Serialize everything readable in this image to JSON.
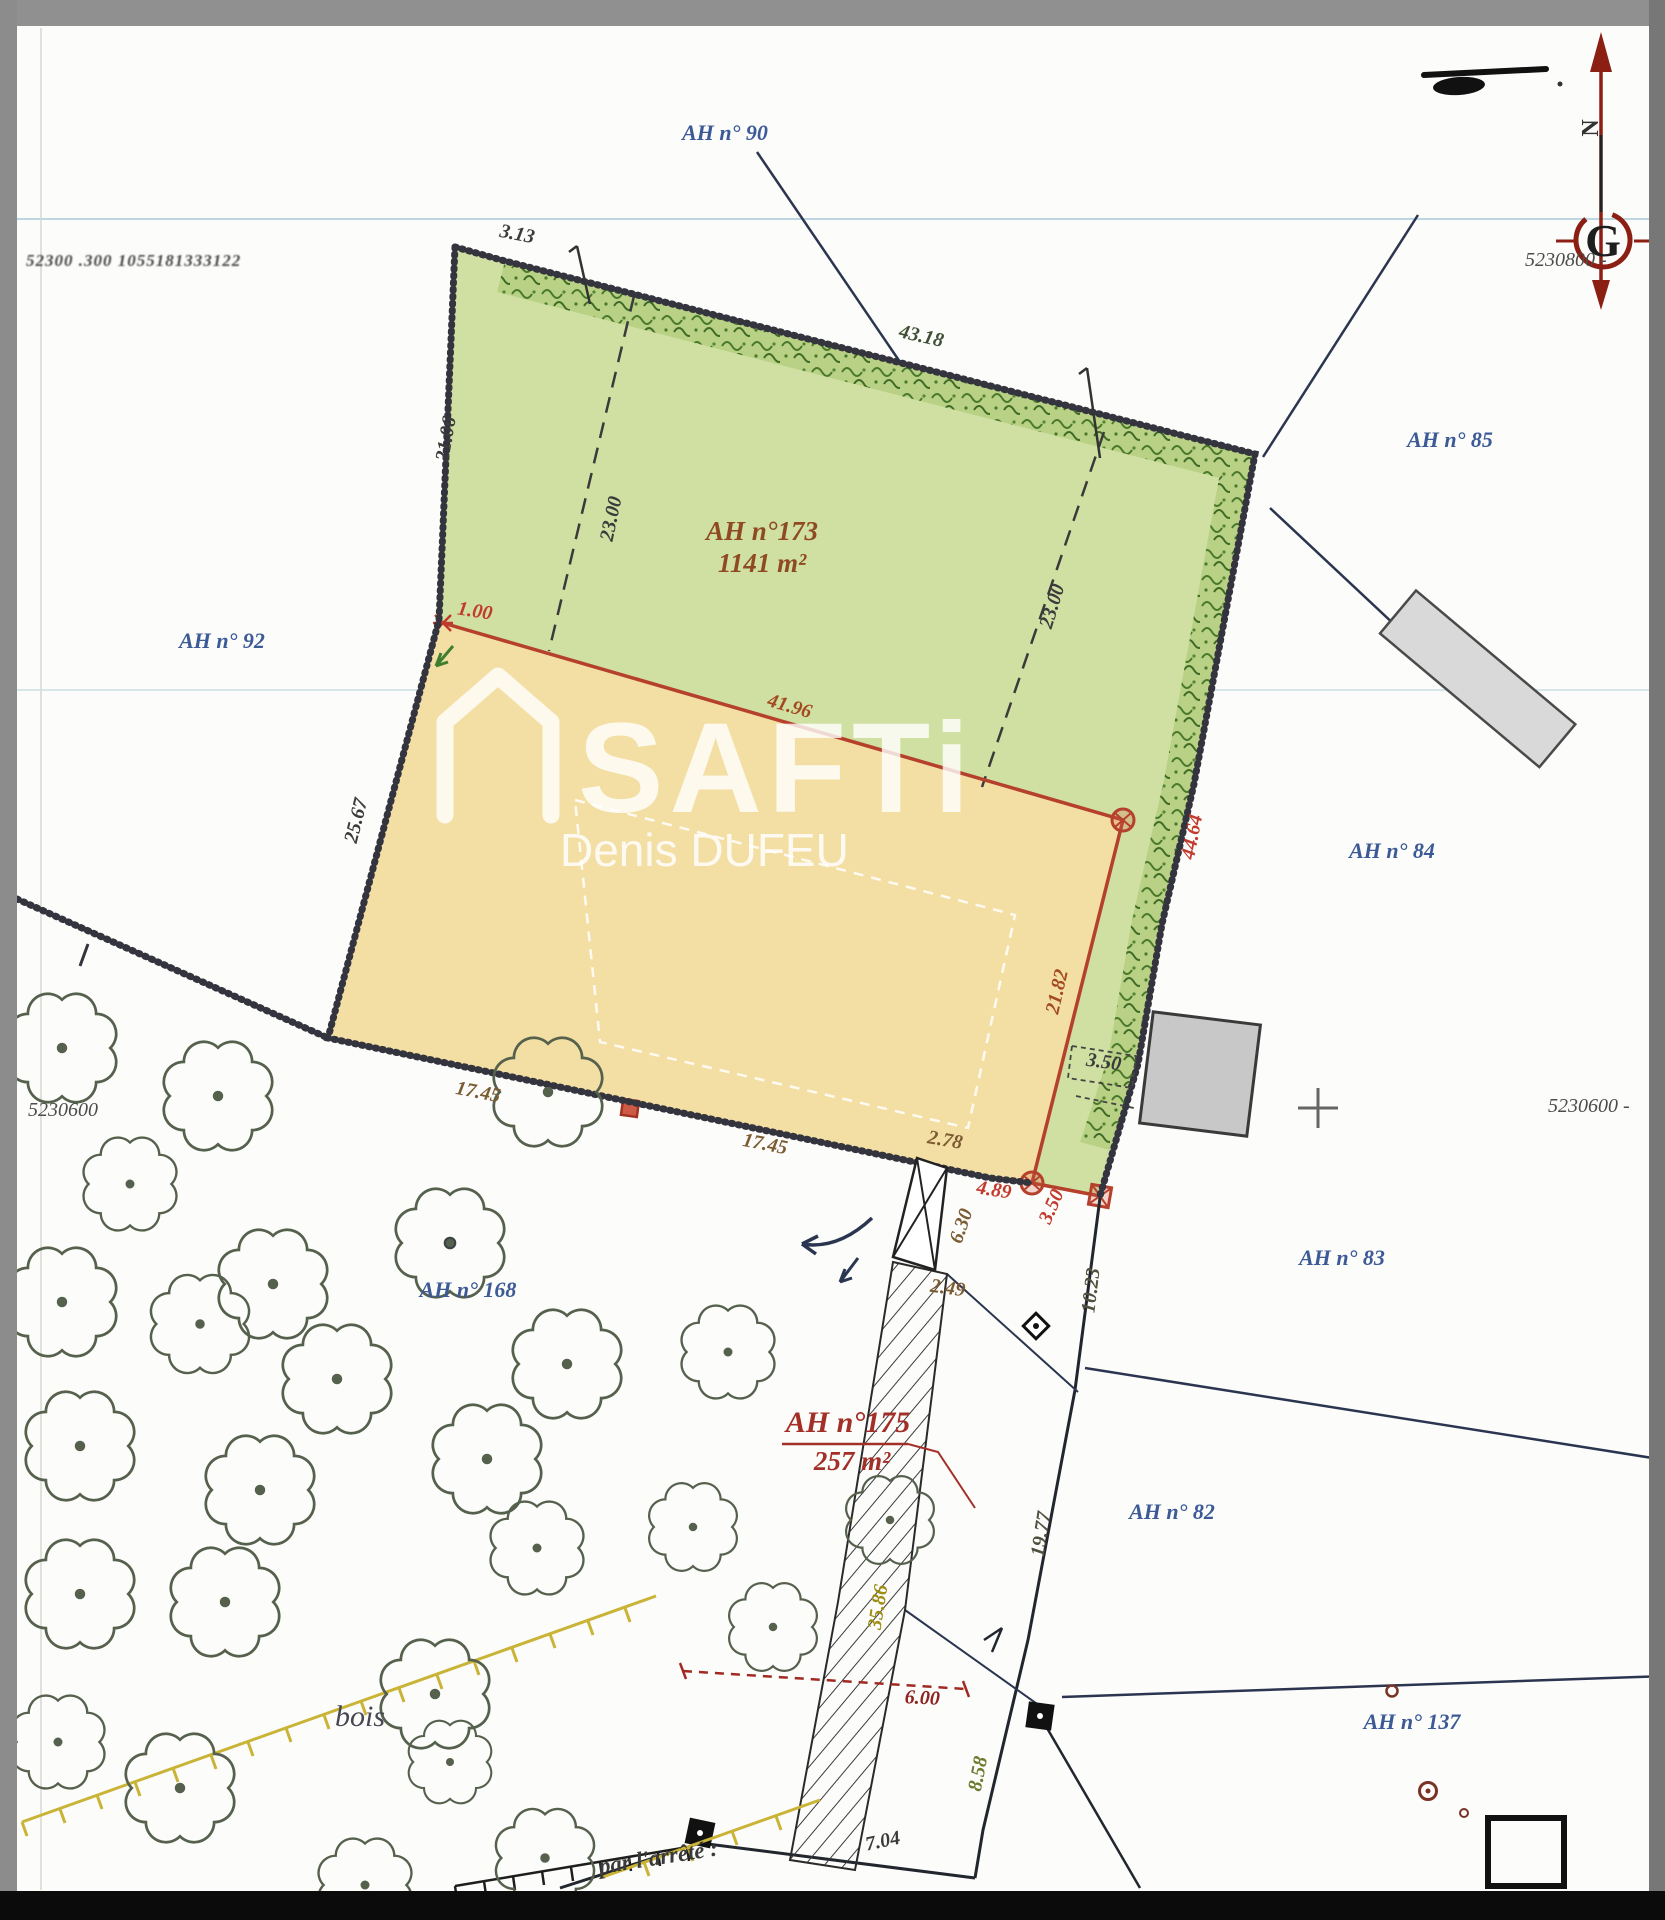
{
  "watermark": {
    "brand": "SAFTi",
    "agent": "Denis DUFEU"
  },
  "compass": {
    "north": "N",
    "grid_letter": "G"
  },
  "grid_labels": {
    "top_left": "52300 .300   1055181333122",
    "top_right": "5230800 -",
    "bottom_left": "5230600",
    "bottom_right": "5230600 -"
  },
  "annotations": {
    "bottom_text": "par l'arrêté :",
    "bois": "bois"
  },
  "parcels": {
    "main": {
      "id": "AH n°173",
      "area": "1141 m²"
    },
    "strip": {
      "id": "AH n°175",
      "area": "257 m²"
    },
    "neighbors": [
      {
        "label": "AH n° 90",
        "x": 725,
        "y": 140
      },
      {
        "label": "AH n° 92",
        "x": 222,
        "y": 648
      },
      {
        "label": "AH n° 85",
        "x": 1450,
        "y": 447
      },
      {
        "label": "AH n° 84",
        "x": 1392,
        "y": 858
      },
      {
        "label": "AH n° 83",
        "x": 1342,
        "y": 1265
      },
      {
        "label": "AH n° 82",
        "x": 1172,
        "y": 1519
      },
      {
        "label": "AH n° 137",
        "x": 1412,
        "y": 1729
      },
      {
        "label": "AH n° 168",
        "x": 468,
        "y": 1297
      }
    ]
  },
  "dimensions": [
    {
      "t": "3.13",
      "x": 516,
      "y": 240,
      "r": 11,
      "c": "k",
      "s": 18
    },
    {
      "t": "21.06",
      "x": 452,
      "y": 440,
      "r": -80,
      "c": "k"
    },
    {
      "t": "43.18",
      "x": 920,
      "y": 342,
      "r": 13,
      "c": "g",
      "s": 19
    },
    {
      "t": "23.00",
      "x": 617,
      "y": 520,
      "r": -78,
      "c": "k"
    },
    {
      "t": "23.00",
      "x": 1058,
      "y": 608,
      "r": -73,
      "c": "k"
    },
    {
      "t": "25.67",
      "x": 362,
      "y": 822,
      "r": -76,
      "c": "k"
    },
    {
      "t": "1.00",
      "x": 474,
      "y": 617,
      "r": 9,
      "c": "r",
      "s": 18
    },
    {
      "t": "41.96",
      "x": 788,
      "y": 712,
      "r": 16,
      "c": "br"
    },
    {
      "t": "44.64",
      "x": 1198,
      "y": 838,
      "r": -79,
      "c": "r",
      "s": 21
    },
    {
      "t": "21.82",
      "x": 1063,
      "y": 993,
      "r": -77,
      "c": "br"
    },
    {
      "t": "17.45",
      "x": 477,
      "y": 1098,
      "r": 11,
      "c": "bn"
    },
    {
      "t": "17.45",
      "x": 764,
      "y": 1150,
      "r": 11,
      "c": "bn"
    },
    {
      "t": "2.78",
      "x": 944,
      "y": 1146,
      "r": 10,
      "c": "bn",
      "s": 18
    },
    {
      "t": "4.89",
      "x": 993,
      "y": 1196,
      "r": 9,
      "c": "r",
      "s": 18
    },
    {
      "t": "3.50",
      "x": 1057,
      "y": 1209,
      "r": -66,
      "c": "r",
      "s": 16
    },
    {
      "t": "3.50",
      "x": 1103,
      "y": 1068,
      "r": 8,
      "c": "k",
      "s": 17
    },
    {
      "t": "6.30",
      "x": 967,
      "y": 1228,
      "r": -71,
      "c": "bn",
      "s": 17
    },
    {
      "t": "2.49",
      "x": 947,
      "y": 1294,
      "r": 8,
      "c": "bn",
      "s": 18
    },
    {
      "t": "10.23",
      "x": 1097,
      "y": 1291,
      "r": -83,
      "c": "k2"
    },
    {
      "t": "19.77",
      "x": 1047,
      "y": 1535,
      "r": -81,
      "c": "k2"
    },
    {
      "t": "35.86",
      "x": 884,
      "y": 1608,
      "r": -81,
      "c": "y"
    },
    {
      "t": "8.58",
      "x": 984,
      "y": 1775,
      "r": -79,
      "c": "ol"
    },
    {
      "t": "6.00",
      "x": 922,
      "y": 1704,
      "r": 3,
      "c": "dr"
    },
    {
      "t": "7.04",
      "x": 884,
      "y": 1847,
      "r": -12,
      "c": "k"
    }
  ],
  "trees": [
    {
      "x": 62,
      "y": 1048
    },
    {
      "x": 218,
      "y": 1096
    },
    {
      "x": 548,
      "y": 1092
    },
    {
      "x": 130,
      "y": 1184,
      "s": 0.9
    },
    {
      "x": 450,
      "y": 1243,
      "b": true
    },
    {
      "x": 273,
      "y": 1284
    },
    {
      "x": 62,
      "y": 1302
    },
    {
      "x": 200,
      "y": 1324,
      "s": 0.95
    },
    {
      "x": 337,
      "y": 1379
    },
    {
      "x": 567,
      "y": 1364
    },
    {
      "x": 728,
      "y": 1352,
      "s": 0.9
    },
    {
      "x": 80,
      "y": 1446
    },
    {
      "x": 487,
      "y": 1459
    },
    {
      "x": 260,
      "y": 1490
    },
    {
      "x": 693,
      "y": 1527,
      "s": 0.85
    },
    {
      "x": 890,
      "y": 1520,
      "s": 0.85
    },
    {
      "x": 537,
      "y": 1548,
      "s": 0.9
    },
    {
      "x": 80,
      "y": 1594
    },
    {
      "x": 225,
      "y": 1602
    },
    {
      "x": 773,
      "y": 1627,
      "s": 0.85
    },
    {
      "x": 435,
      "y": 1694
    },
    {
      "x": 180,
      "y": 1788
    },
    {
      "x": 450,
      "y": 1762,
      "s": 0.8
    },
    {
      "x": 545,
      "y": 1858,
      "s": 0.95
    },
    {
      "x": 365,
      "y": 1885,
      "s": 0.9
    },
    {
      "x": 58,
      "y": 1742,
      "s": 0.9
    }
  ],
  "colors": {
    "parcel_green": "#cfe0a2",
    "parcel_yellow": "#f3dfa4",
    "hedge_green": "#49792c",
    "boundary": "#34343e",
    "red_line": "#b5402c",
    "blue_label": "#3c5a96",
    "north_red": "#8b1f14",
    "watermark_white": "#ffffff"
  }
}
